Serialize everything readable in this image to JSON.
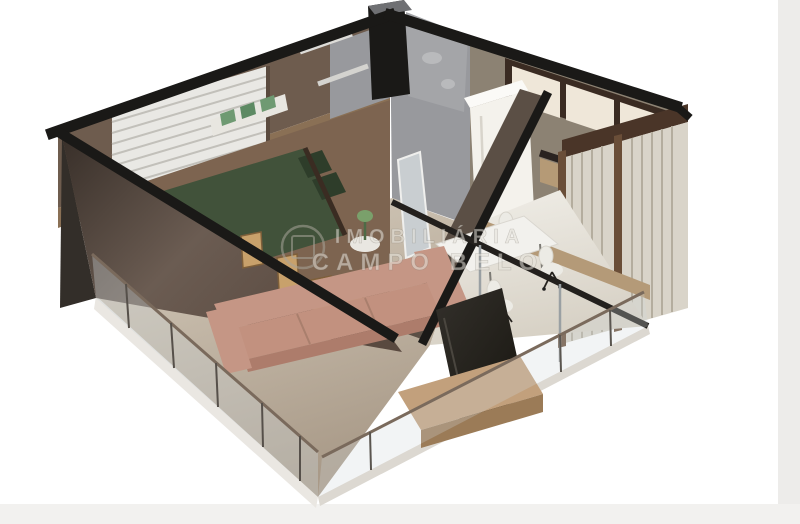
{
  "meta": {
    "title": "3D isometric cutaway floor plan render of a one-bedroom apartment",
    "rooms_depicted": [
      "bedroom",
      "bathroom",
      "hall",
      "kitchen",
      "dining-area",
      "living-room",
      "balcony"
    ]
  },
  "watermark": {
    "logo": "circle-and-square-emblem",
    "line1": "IMOBILIÁRIA",
    "line2": "CAMPO BELO"
  },
  "palette": {
    "background": "#ffffff",
    "edge_band": "#edecea",
    "bottom_band": "#f2f1ef",
    "beam_black": "#1a1917",
    "wall_brown": "#6e5c4e",
    "wall_brown_dark": "#443a33",
    "wall_gray": "#98999d",
    "wall_gray_light": "#a4a5a8",
    "blind_light": "#e9e8e4",
    "sill_wood": "#8a7055",
    "floor_wood": "#7d6450",
    "floor_beige": "#cdc3b4",
    "floor_ivory": "#e9e6df",
    "slab_edge": "#eae7e2",
    "slab_edge_right": "#dcd8d1",
    "bed_green": "#41523a",
    "pillow_green": "#2e3d2a",
    "sheet_white": "#d9dbd2",
    "lamp_green": "#7aa06b",
    "shelf_green": "#6f9a72",
    "frame_tan": "#c8a16b",
    "sofa_salmon": "#c59685",
    "sofa_salmon_mid": "#c2917f",
    "sofa_salmon_dark": "#ad7c6b",
    "fridge_white": "#f4f2ec",
    "cabinet_cream": "#efe7d9",
    "cabinet_trim": "#3a2b22",
    "counter_wood": "#b59a76",
    "tv_dark": "#26231f",
    "bench_wood": "#c2a07c",
    "bench_wood_dark": "#9b7b57",
    "wardrobe_slat": "#d9d4c9",
    "wardrobe_trim": "#6a4e38",
    "wardrobe_band": "#4a3528",
    "mirror": "#c9ced1",
    "glass_rail": "#7a6a5c",
    "watermark_fill": "#e7e4dc",
    "watermark_edge": "#6f6a60"
  }
}
